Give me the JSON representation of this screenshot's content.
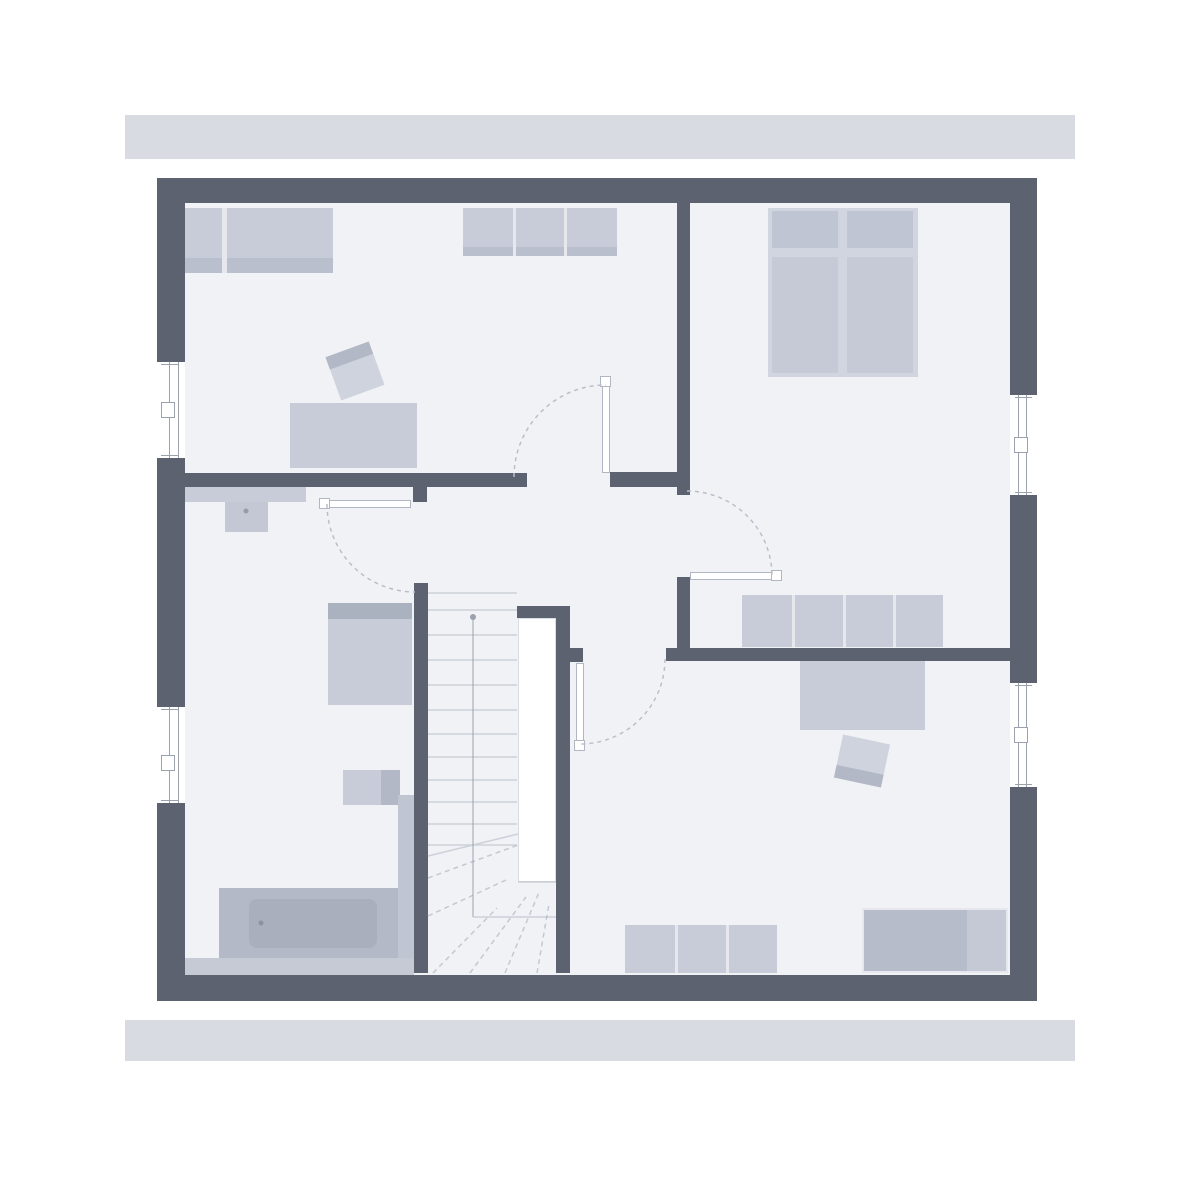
{
  "meta": {
    "description": "attic floor plan, no text labels visible"
  },
  "canvas": {
    "width": 1200,
    "height": 1200,
    "background": "#ffffff"
  },
  "colors": {
    "facade_bar": "#d8dbe2",
    "wall": "#5c6270",
    "floor": "#f1f2f6",
    "furniture_light": "#c7ccd8",
    "furniture_medium": "#b6bcc9",
    "furniture_dark": "#a9afbd",
    "divider": "#e6e8ee",
    "line_light": "#ccd1da",
    "line_dash": "#c3c8d2",
    "arc_dash": "#b9bfca",
    "frame_line": "#9ba2ae"
  },
  "rects": [
    {
      "name": "top-facade-bar",
      "x": 125,
      "y": 115,
      "w": 950,
      "h": 44,
      "bg": "#d8dbe2"
    },
    {
      "name": "bottom-facade-bar",
      "x": 125,
      "y": 1020,
      "w": 950,
      "h": 41,
      "bg": "#d8dbe2"
    },
    {
      "name": "floor",
      "x": 185,
      "y": 203,
      "w": 825,
      "h": 772,
      "bg": "#f1f2f6"
    },
    {
      "name": "wardrobe-top-left",
      "x": 185,
      "y": 208,
      "w": 148,
      "h": 65,
      "bg": "#c7ccd8"
    },
    {
      "name": "wardrobe-top-left-shade",
      "x": 185,
      "y": 258,
      "w": 148,
      "h": 15,
      "bg": "#b9bfcc"
    },
    {
      "name": "wardrobe-top-left-divider",
      "x": 222,
      "y": 208,
      "w": 5,
      "h": 65,
      "bg": "#e6e8ee"
    },
    {
      "name": "closet-north",
      "x": 463,
      "y": 208,
      "w": 154,
      "h": 48,
      "bg": "#c7ccd8"
    },
    {
      "name": "closet-north-shade",
      "x": 463,
      "y": 247,
      "w": 154,
      "h": 9,
      "bg": "#b9bfcc"
    },
    {
      "name": "closet-north-divider-1",
      "x": 513,
      "y": 208,
      "w": 3,
      "h": 48,
      "bg": "#e6e8ee"
    },
    {
      "name": "closet-north-divider-2",
      "x": 564,
      "y": 208,
      "w": 3,
      "h": 48,
      "bg": "#e6e8ee"
    },
    {
      "name": "desk-left-room",
      "x": 290,
      "y": 403,
      "w": 127,
      "h": 65,
      "bg": "#c7ccd8"
    },
    {
      "name": "chair-left-room",
      "x": 332,
      "y": 348,
      "w": 46,
      "h": 46,
      "bg": "#ced3dd",
      "rotate": -20,
      "children": [
        {
          "name": "chair-left-room-backrest",
          "x": 0,
          "y": 0,
          "w": 46,
          "h": 13,
          "bg": "#b2b8c5"
        }
      ]
    },
    {
      "name": "bed-frame",
      "x": 768,
      "y": 208,
      "w": 150,
      "h": 169,
      "bg": "#d0d5df"
    },
    {
      "name": "bed-pillow-left",
      "x": 772,
      "y": 211,
      "w": 66,
      "h": 37,
      "bg": "#bfc5d2"
    },
    {
      "name": "bed-pillow-right",
      "x": 847,
      "y": 211,
      "w": 66,
      "h": 37,
      "bg": "#bfc5d2"
    },
    {
      "name": "bed-mattress-left",
      "x": 772,
      "y": 257,
      "w": 66,
      "h": 116,
      "bg": "#c5cad6"
    },
    {
      "name": "bed-mattress-right",
      "x": 847,
      "y": 257,
      "w": 66,
      "h": 116,
      "bg": "#c5cad6"
    },
    {
      "name": "sideboard-hall",
      "x": 742,
      "y": 595,
      "w": 201,
      "h": 52,
      "bg": "#c7ccd8"
    },
    {
      "name": "sideboard-hall-divider-1",
      "x": 792,
      "y": 595,
      "w": 3,
      "h": 52,
      "bg": "#e6e8ee"
    },
    {
      "name": "sideboard-hall-divider-2",
      "x": 843,
      "y": 595,
      "w": 3,
      "h": 52,
      "bg": "#e6e8ee"
    },
    {
      "name": "sideboard-hall-divider-3",
      "x": 893,
      "y": 595,
      "w": 3,
      "h": 52,
      "bg": "#e6e8ee"
    },
    {
      "name": "desk-right-room",
      "x": 800,
      "y": 661,
      "w": 125,
      "h": 69,
      "bg": "#c7ccd8"
    },
    {
      "name": "chair-right-room",
      "x": 838,
      "y": 739,
      "w": 48,
      "h": 44,
      "bg": "#ced3dd",
      "rotate": 12,
      "children": [
        {
          "name": "chair-right-room-backrest",
          "x": 0,
          "y": 31,
          "w": 48,
          "h": 13,
          "bg": "#b2b8c5"
        }
      ]
    },
    {
      "name": "sideboard-south",
      "x": 625,
      "y": 925,
      "w": 152,
      "h": 48,
      "bg": "#c7ccd8"
    },
    {
      "name": "sideboard-south-divider-1",
      "x": 675,
      "y": 925,
      "w": 3,
      "h": 48,
      "bg": "#e6e8ee"
    },
    {
      "name": "sideboard-south-divider-2",
      "x": 726,
      "y": 925,
      "w": 3,
      "h": 48,
      "bg": "#e6e8ee"
    },
    {
      "name": "dresser-south-east",
      "x": 862,
      "y": 908,
      "w": 146,
      "h": 65,
      "bg": "#b6bcc9",
      "border": "2px solid #e6e8ee"
    },
    {
      "name": "dresser-south-east-right-section",
      "x": 967,
      "y": 910,
      "w": 39,
      "h": 61,
      "bg": "#c4c9d5"
    },
    {
      "name": "bath-shelf",
      "x": 185,
      "y": 487,
      "w": 121,
      "h": 15,
      "bg": "#c7ccd8"
    },
    {
      "name": "washbasin",
      "x": 225,
      "y": 502,
      "w": 43,
      "h": 30,
      "bg": "#c3c8d4"
    },
    {
      "name": "bath-wardrobe-shade",
      "x": 328,
      "y": 603,
      "w": 84,
      "h": 16,
      "bg": "#aab1bf"
    },
    {
      "name": "bath-wardrobe",
      "x": 328,
      "y": 619,
      "w": 84,
      "h": 86,
      "bg": "#c7ccd8"
    },
    {
      "name": "bath-cabinet-left",
      "x": 343,
      "y": 770,
      "w": 38,
      "h": 35,
      "bg": "#c7ccd8"
    },
    {
      "name": "bath-cabinet-right",
      "x": 381,
      "y": 770,
      "w": 19,
      "h": 35,
      "bg": "#b2b8c5"
    },
    {
      "name": "bath-side-counter",
      "x": 398,
      "y": 795,
      "w": 16,
      "h": 180,
      "bg": "#bfc5d1"
    },
    {
      "name": "bath-floor-strip",
      "x": 185,
      "y": 958,
      "w": 229,
      "h": 17,
      "bg": "#c5cad5"
    },
    {
      "name": "bathtub-surround",
      "x": 219,
      "y": 888,
      "w": 179,
      "h": 70,
      "bg": "#b3b9c6"
    },
    {
      "name": "bathtub-inner",
      "x": 249,
      "y": 899,
      "w": 128,
      "h": 49,
      "bg": "#a9afbd",
      "radius": 8
    },
    {
      "name": "stair-void",
      "x": 518,
      "y": 618,
      "w": 38,
      "h": 264,
      "bg": "#ffffff",
      "border": "1px solid #d8dce3"
    },
    {
      "name": "outer-wall-top",
      "x": 157,
      "y": 178,
      "w": 880,
      "h": 25,
      "bg": "#5c6270"
    },
    {
      "name": "outer-wall-bottom",
      "x": 157,
      "y": 975,
      "w": 880,
      "h": 26,
      "bg": "#5c6270"
    },
    {
      "name": "outer-wall-left",
      "x": 157,
      "y": 178,
      "w": 28,
      "h": 823,
      "bg": "#5c6270"
    },
    {
      "name": "outer-wall-right",
      "x": 1010,
      "y": 178,
      "w": 27,
      "h": 823,
      "bg": "#5c6270"
    },
    {
      "name": "wall-bedrooms-divider",
      "x": 677,
      "y": 203,
      "w": 13,
      "h": 292,
      "bg": "#5c6270"
    },
    {
      "name": "wall-bath-north",
      "x": 185,
      "y": 473,
      "w": 342,
      "h": 14,
      "bg": "#5c6270"
    },
    {
      "name": "wall-hall-north",
      "x": 610,
      "y": 472,
      "w": 80,
      "h": 15,
      "bg": "#5c6270"
    },
    {
      "name": "wall-bedroom2-west",
      "x": 677,
      "y": 577,
      "w": 13,
      "h": 73,
      "bg": "#5c6270"
    },
    {
      "name": "wall-south-rooms",
      "x": 666,
      "y": 648,
      "w": 344,
      "h": 13,
      "bg": "#5c6270"
    },
    {
      "name": "wall-stair-stub",
      "x": 560,
      "y": 648,
      "w": 23,
      "h": 14,
      "bg": "#5c6270"
    },
    {
      "name": "wall-stair-north",
      "x": 517,
      "y": 606,
      "w": 44,
      "h": 12,
      "bg": "#5c6270"
    },
    {
      "name": "wall-stair-east",
      "x": 556,
      "y": 606,
      "w": 14,
      "h": 367,
      "bg": "#5c6270"
    },
    {
      "name": "wall-stair-west",
      "x": 414,
      "y": 583,
      "w": 14,
      "h": 390,
      "bg": "#5c6270"
    },
    {
      "name": "wall-bath-stub",
      "x": 413,
      "y": 484,
      "w": 14,
      "h": 18,
      "bg": "#5c6270"
    },
    {
      "name": "window-left-1",
      "x": 157,
      "y": 362,
      "w": 28,
      "h": 96,
      "bg": "#ffffff",
      "children": [
        {
          "name": "window-left-1-frame-line-a",
          "x": 12,
          "y": 0,
          "w": 1,
          "h": 96,
          "bg": "#9ba2ae"
        },
        {
          "name": "window-left-1-frame-line-b",
          "x": 21,
          "y": 0,
          "w": 1,
          "h": 96,
          "bg": "#9ba2ae"
        },
        {
          "name": "window-left-1-tick-top",
          "x": 4,
          "y": 2,
          "w": 18,
          "h": 1,
          "bg": "#9ba2ae"
        },
        {
          "name": "window-left-1-tick-bottom",
          "x": 4,
          "y": 93,
          "w": 18,
          "h": 1,
          "bg": "#9ba2ae"
        },
        {
          "name": "window-left-1-sash",
          "x": 4,
          "y": 40,
          "w": 14,
          "h": 16,
          "bg": "#ffffff",
          "border": "1px solid #9ba2ae"
        }
      ]
    },
    {
      "name": "window-left-2",
      "x": 157,
      "y": 707,
      "w": 28,
      "h": 96,
      "bg": "#ffffff",
      "children": [
        {
          "name": "window-left-2-frame-line-a",
          "x": 12,
          "y": 0,
          "w": 1,
          "h": 96,
          "bg": "#9ba2ae"
        },
        {
          "name": "window-left-2-frame-line-b",
          "x": 21,
          "y": 0,
          "w": 1,
          "h": 96,
          "bg": "#9ba2ae"
        },
        {
          "name": "window-left-2-tick-top",
          "x": 4,
          "y": 2,
          "w": 18,
          "h": 1,
          "bg": "#9ba2ae"
        },
        {
          "name": "window-left-2-tick-bottom",
          "x": 4,
          "y": 93,
          "w": 18,
          "h": 1,
          "bg": "#9ba2ae"
        },
        {
          "name": "window-left-2-sash",
          "x": 4,
          "y": 48,
          "w": 14,
          "h": 16,
          "bg": "#ffffff",
          "border": "1px solid #9ba2ae"
        }
      ]
    },
    {
      "name": "window-right-1",
      "x": 1010,
      "y": 395,
      "w": 27,
      "h": 100,
      "bg": "#ffffff",
      "children": [
        {
          "name": "window-right-1-frame-line-a",
          "x": 8,
          "y": 0,
          "w": 1,
          "h": 100,
          "bg": "#9ba2ae"
        },
        {
          "name": "window-right-1-frame-line-b",
          "x": 16,
          "y": 0,
          "w": 1,
          "h": 100,
          "bg": "#9ba2ae"
        },
        {
          "name": "window-right-1-tick-top",
          "x": 5,
          "y": 2,
          "w": 17,
          "h": 1,
          "bg": "#9ba2ae"
        },
        {
          "name": "window-right-1-tick-bottom",
          "x": 5,
          "y": 97,
          "w": 17,
          "h": 1,
          "bg": "#9ba2ae"
        },
        {
          "name": "window-right-1-sash",
          "x": 4,
          "y": 42,
          "w": 14,
          "h": 16,
          "bg": "#ffffff",
          "border": "1px solid #9ba2ae"
        }
      ]
    },
    {
      "name": "window-right-2",
      "x": 1010,
      "y": 683,
      "w": 27,
      "h": 104,
      "bg": "#ffffff",
      "children": [
        {
          "name": "window-right-2-frame-line-a",
          "x": 8,
          "y": 0,
          "w": 1,
          "h": 104,
          "bg": "#9ba2ae"
        },
        {
          "name": "window-right-2-frame-line-b",
          "x": 16,
          "y": 0,
          "w": 1,
          "h": 104,
          "bg": "#9ba2ae"
        },
        {
          "name": "window-right-2-tick-top",
          "x": 5,
          "y": 2,
          "w": 17,
          "h": 1,
          "bg": "#9ba2ae"
        },
        {
          "name": "window-right-2-tick-bottom",
          "x": 5,
          "y": 101,
          "w": 17,
          "h": 1,
          "bg": "#9ba2ae"
        },
        {
          "name": "window-right-2-sash",
          "x": 4,
          "y": 44,
          "w": 14,
          "h": 16,
          "bg": "#ffffff",
          "border": "1px solid #9ba2ae"
        }
      ]
    },
    {
      "name": "door-leaf-left-room",
      "x": 602,
      "y": 378,
      "w": 8,
      "h": 95,
      "bg": "#ffffff",
      "border": "1px solid #b0b6c2"
    },
    {
      "name": "door-cap-left-room",
      "x": 600,
      "y": 376,
      "w": 11,
      "h": 11,
      "bg": "#ffffff",
      "border": "1px solid #b0b6c2"
    },
    {
      "name": "door-leaf-bedroom2",
      "x": 690,
      "y": 572,
      "w": 90,
      "h": 8,
      "bg": "#ffffff",
      "border": "1px solid #b0b6c2"
    },
    {
      "name": "door-cap-bedroom2",
      "x": 771,
      "y": 570,
      "w": 11,
      "h": 11,
      "bg": "#ffffff",
      "border": "1px solid #b0b6c2"
    },
    {
      "name": "door-leaf-south-room",
      "x": 576,
      "y": 663,
      "w": 8,
      "h": 87,
      "bg": "#ffffff",
      "border": "1px solid #b0b6c2"
    },
    {
      "name": "door-cap-south-room",
      "x": 574,
      "y": 740,
      "w": 11,
      "h": 11,
      "bg": "#ffffff",
      "border": "1px solid #b0b6c2"
    },
    {
      "name": "door-leaf-bath",
      "x": 321,
      "y": 500,
      "w": 90,
      "h": 8,
      "bg": "#ffffff",
      "border": "1px solid #b0b6c2"
    },
    {
      "name": "door-cap-bath",
      "x": 319,
      "y": 498,
      "w": 11,
      "h": 11,
      "bg": "#ffffff",
      "border": "1px solid #b0b6c2"
    }
  ],
  "linework": {
    "lines": [
      {
        "name": "stair-tread-1",
        "x1": 428,
        "y1": 593,
        "x2": 517,
        "y2": 593,
        "stroke": "#ccd1da",
        "w": 1.5
      },
      {
        "name": "stair-tread-2",
        "x1": 428,
        "y1": 610,
        "x2": 517,
        "y2": 610,
        "stroke": "#ccd1da",
        "w": 1.5
      },
      {
        "name": "stair-tread-3",
        "x1": 428,
        "y1": 635,
        "x2": 517,
        "y2": 635,
        "stroke": "#ccd1da",
        "w": 1.5
      },
      {
        "name": "stair-tread-4",
        "x1": 428,
        "y1": 660,
        "x2": 517,
        "y2": 660,
        "stroke": "#ccd1da",
        "w": 1.5
      },
      {
        "name": "stair-tread-5",
        "x1": 428,
        "y1": 685,
        "x2": 517,
        "y2": 685,
        "stroke": "#ccd1da",
        "w": 1.5
      },
      {
        "name": "stair-tread-6",
        "x1": 428,
        "y1": 710,
        "x2": 517,
        "y2": 710,
        "stroke": "#ccd1da",
        "w": 1.5
      },
      {
        "name": "stair-tread-7",
        "x1": 428,
        "y1": 734,
        "x2": 517,
        "y2": 734,
        "stroke": "#ccd1da",
        "w": 1.5
      },
      {
        "name": "stair-tread-8",
        "x1": 428,
        "y1": 757,
        "x2": 517,
        "y2": 757,
        "stroke": "#ccd1da",
        "w": 1.5
      },
      {
        "name": "stair-tread-9",
        "x1": 428,
        "y1": 780,
        "x2": 517,
        "y2": 780,
        "stroke": "#ccd1da",
        "w": 1.5
      },
      {
        "name": "stair-tread-10",
        "x1": 428,
        "y1": 802,
        "x2": 517,
        "y2": 802,
        "stroke": "#ccd1da",
        "w": 1.5
      },
      {
        "name": "stair-tread-11",
        "x1": 428,
        "y1": 824,
        "x2": 517,
        "y2": 824,
        "stroke": "#ccd1da",
        "w": 1.5
      },
      {
        "name": "stair-tread-12",
        "x1": 428,
        "y1": 845,
        "x2": 517,
        "y2": 845,
        "stroke": "#ccd1da",
        "w": 1.5
      },
      {
        "name": "stair-winder-solid",
        "x1": 428,
        "y1": 856,
        "x2": 518,
        "y2": 834,
        "stroke": "#ccd1da",
        "w": 1.5
      },
      {
        "name": "stair-winder-dash-1",
        "x1": 428,
        "y1": 878,
        "x2": 518,
        "y2": 845,
        "stroke": "#c3c8d2",
        "w": 1.5,
        "dash": "5,4"
      },
      {
        "name": "stair-winder-dash-2",
        "x1": 428,
        "y1": 916,
        "x2": 506,
        "y2": 880,
        "stroke": "#c3c8d2",
        "w": 1.5,
        "dash": "5,4"
      },
      {
        "name": "stair-winder-dash-3",
        "x1": 433,
        "y1": 973,
        "x2": 497,
        "y2": 908,
        "stroke": "#c3c8d2",
        "w": 1.5,
        "dash": "5,4"
      },
      {
        "name": "stair-winder-dash-4",
        "x1": 470,
        "y1": 973,
        "x2": 526,
        "y2": 897,
        "stroke": "#c3c8d2",
        "w": 1.5,
        "dash": "5,4"
      },
      {
        "name": "stair-winder-dash-5",
        "x1": 505,
        "y1": 973,
        "x2": 540,
        "y2": 890,
        "stroke": "#c3c8d2",
        "w": 1.5,
        "dash": "5,4"
      },
      {
        "name": "stair-winder-dash-6",
        "x1": 537,
        "y1": 973,
        "x2": 549,
        "y2": 904,
        "stroke": "#c3c8d2",
        "w": 1.5,
        "dash": "5,4"
      },
      {
        "name": "stair-walking-line",
        "x1": 473,
        "y1": 617,
        "x2": 473,
        "y2": 917,
        "stroke": "#9aa1ad",
        "w": 1
      },
      {
        "name": "stair-landing-line",
        "x1": 473,
        "y1": 917,
        "x2": 556,
        "y2": 917,
        "stroke": "#b9bfc9",
        "w": 1
      },
      {
        "name": "stair-void-bottom-line",
        "x1": 518,
        "y1": 882,
        "x2": 556,
        "y2": 882,
        "stroke": "#b9bfc9",
        "w": 1
      }
    ],
    "paths": [
      {
        "name": "door-arc-left-room",
        "d": "M 514 477 A 92 92 0 0 1 606 385",
        "stroke": "#b9bfca",
        "w": 1.5,
        "dash": "4,4"
      },
      {
        "name": "door-arc-bedroom2",
        "d": "M 687 491 A 85 85 0 0 1 772 576",
        "stroke": "#b9bfca",
        "w": 1.5,
        "dash": "4,4"
      },
      {
        "name": "door-arc-south-room",
        "d": "M 665 659 A 85 85 0 0 1 580 744",
        "stroke": "#b9bfca",
        "w": 1.5,
        "dash": "4,4"
      },
      {
        "name": "door-arc-bath",
        "d": "M 327 504 A 88 88 0 0 0 415 592",
        "stroke": "#b9bfca",
        "w": 1.5,
        "dash": "4,4"
      }
    ],
    "dots": [
      {
        "name": "stair-walking-line-start-dot",
        "cx": 473,
        "cy": 617,
        "r": 3,
        "fill": "#9aa1ad"
      },
      {
        "name": "washbasin-faucet-dot",
        "cx": 246,
        "cy": 511,
        "r": 2.5,
        "fill": "#959caa"
      },
      {
        "name": "bathtub-drain-dot",
        "cx": 261,
        "cy": 923,
        "r": 2.5,
        "fill": "#8b92a0"
      }
    ]
  }
}
